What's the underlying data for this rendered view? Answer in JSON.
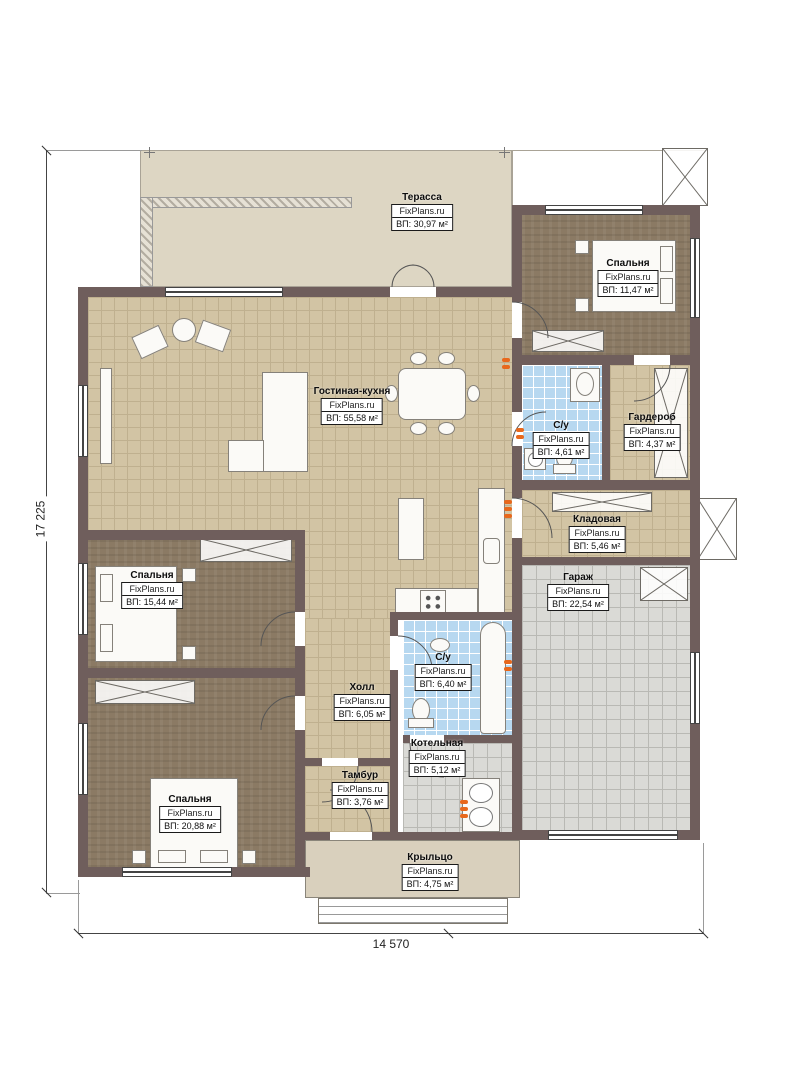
{
  "dimensions": {
    "vertical": "17 225",
    "horizontal": "14 570"
  },
  "rooms": [
    {
      "id": "terrace",
      "name": "Терасса",
      "brand": "FixPlans.ru",
      "area": "ВП: 30,97 м²"
    },
    {
      "id": "bedroom1",
      "name": "Спальня",
      "brand": "FixPlans.ru",
      "area": "ВП: 11,47 м²"
    },
    {
      "id": "living",
      "name": "Гостиная-кухня",
      "brand": "FixPlans.ru",
      "area": "ВП: 55,58 м²"
    },
    {
      "id": "wc1",
      "name": "С/у",
      "brand": "FixPlans.ru",
      "area": "ВП: 4,61 м²"
    },
    {
      "id": "wardrobe",
      "name": "Гардероб",
      "brand": "FixPlans.ru",
      "area": "ВП: 4,37 м²"
    },
    {
      "id": "storage",
      "name": "Кладовая",
      "brand": "FixPlans.ru",
      "area": "ВП: 5,46 м²"
    },
    {
      "id": "garage",
      "name": "Гараж",
      "brand": "FixPlans.ru",
      "area": "ВП: 22,54 м²"
    },
    {
      "id": "bedroom2",
      "name": "Спальня",
      "brand": "FixPlans.ru",
      "area": "ВП: 15,44 м²"
    },
    {
      "id": "hall",
      "name": "Холл",
      "brand": "FixPlans.ru",
      "area": "ВП: 6,05 м²"
    },
    {
      "id": "wc2",
      "name": "С/у",
      "brand": "FixPlans.ru",
      "area": "ВП: 6,40 м²"
    },
    {
      "id": "boiler",
      "name": "Котельная",
      "brand": "FixPlans.ru",
      "area": "ВП: 5,12 м²"
    },
    {
      "id": "vestibule",
      "name": "Тамбур",
      "brand": "FixPlans.ru",
      "area": "ВП: 3,76 м²"
    },
    {
      "id": "bedroom3",
      "name": "Спальня",
      "brand": "FixPlans.ru",
      "area": "ВП: 20,88 м²"
    },
    {
      "id": "porch",
      "name": "Крыльцо",
      "brand": "FixPlans.ru",
      "area": "ВП: 4,75 м²"
    }
  ],
  "colors": {
    "wall": "#6f5e5c",
    "tilebeige": "#d2c4a4",
    "tileline": "#bfb08f",
    "blue": "#b7d8f0",
    "gray": "#dadad6",
    "brown": "#8b7a64",
    "terrace": "#ddd6c3",
    "porch": "#d9d0bd",
    "accent": "#e8681c"
  }
}
